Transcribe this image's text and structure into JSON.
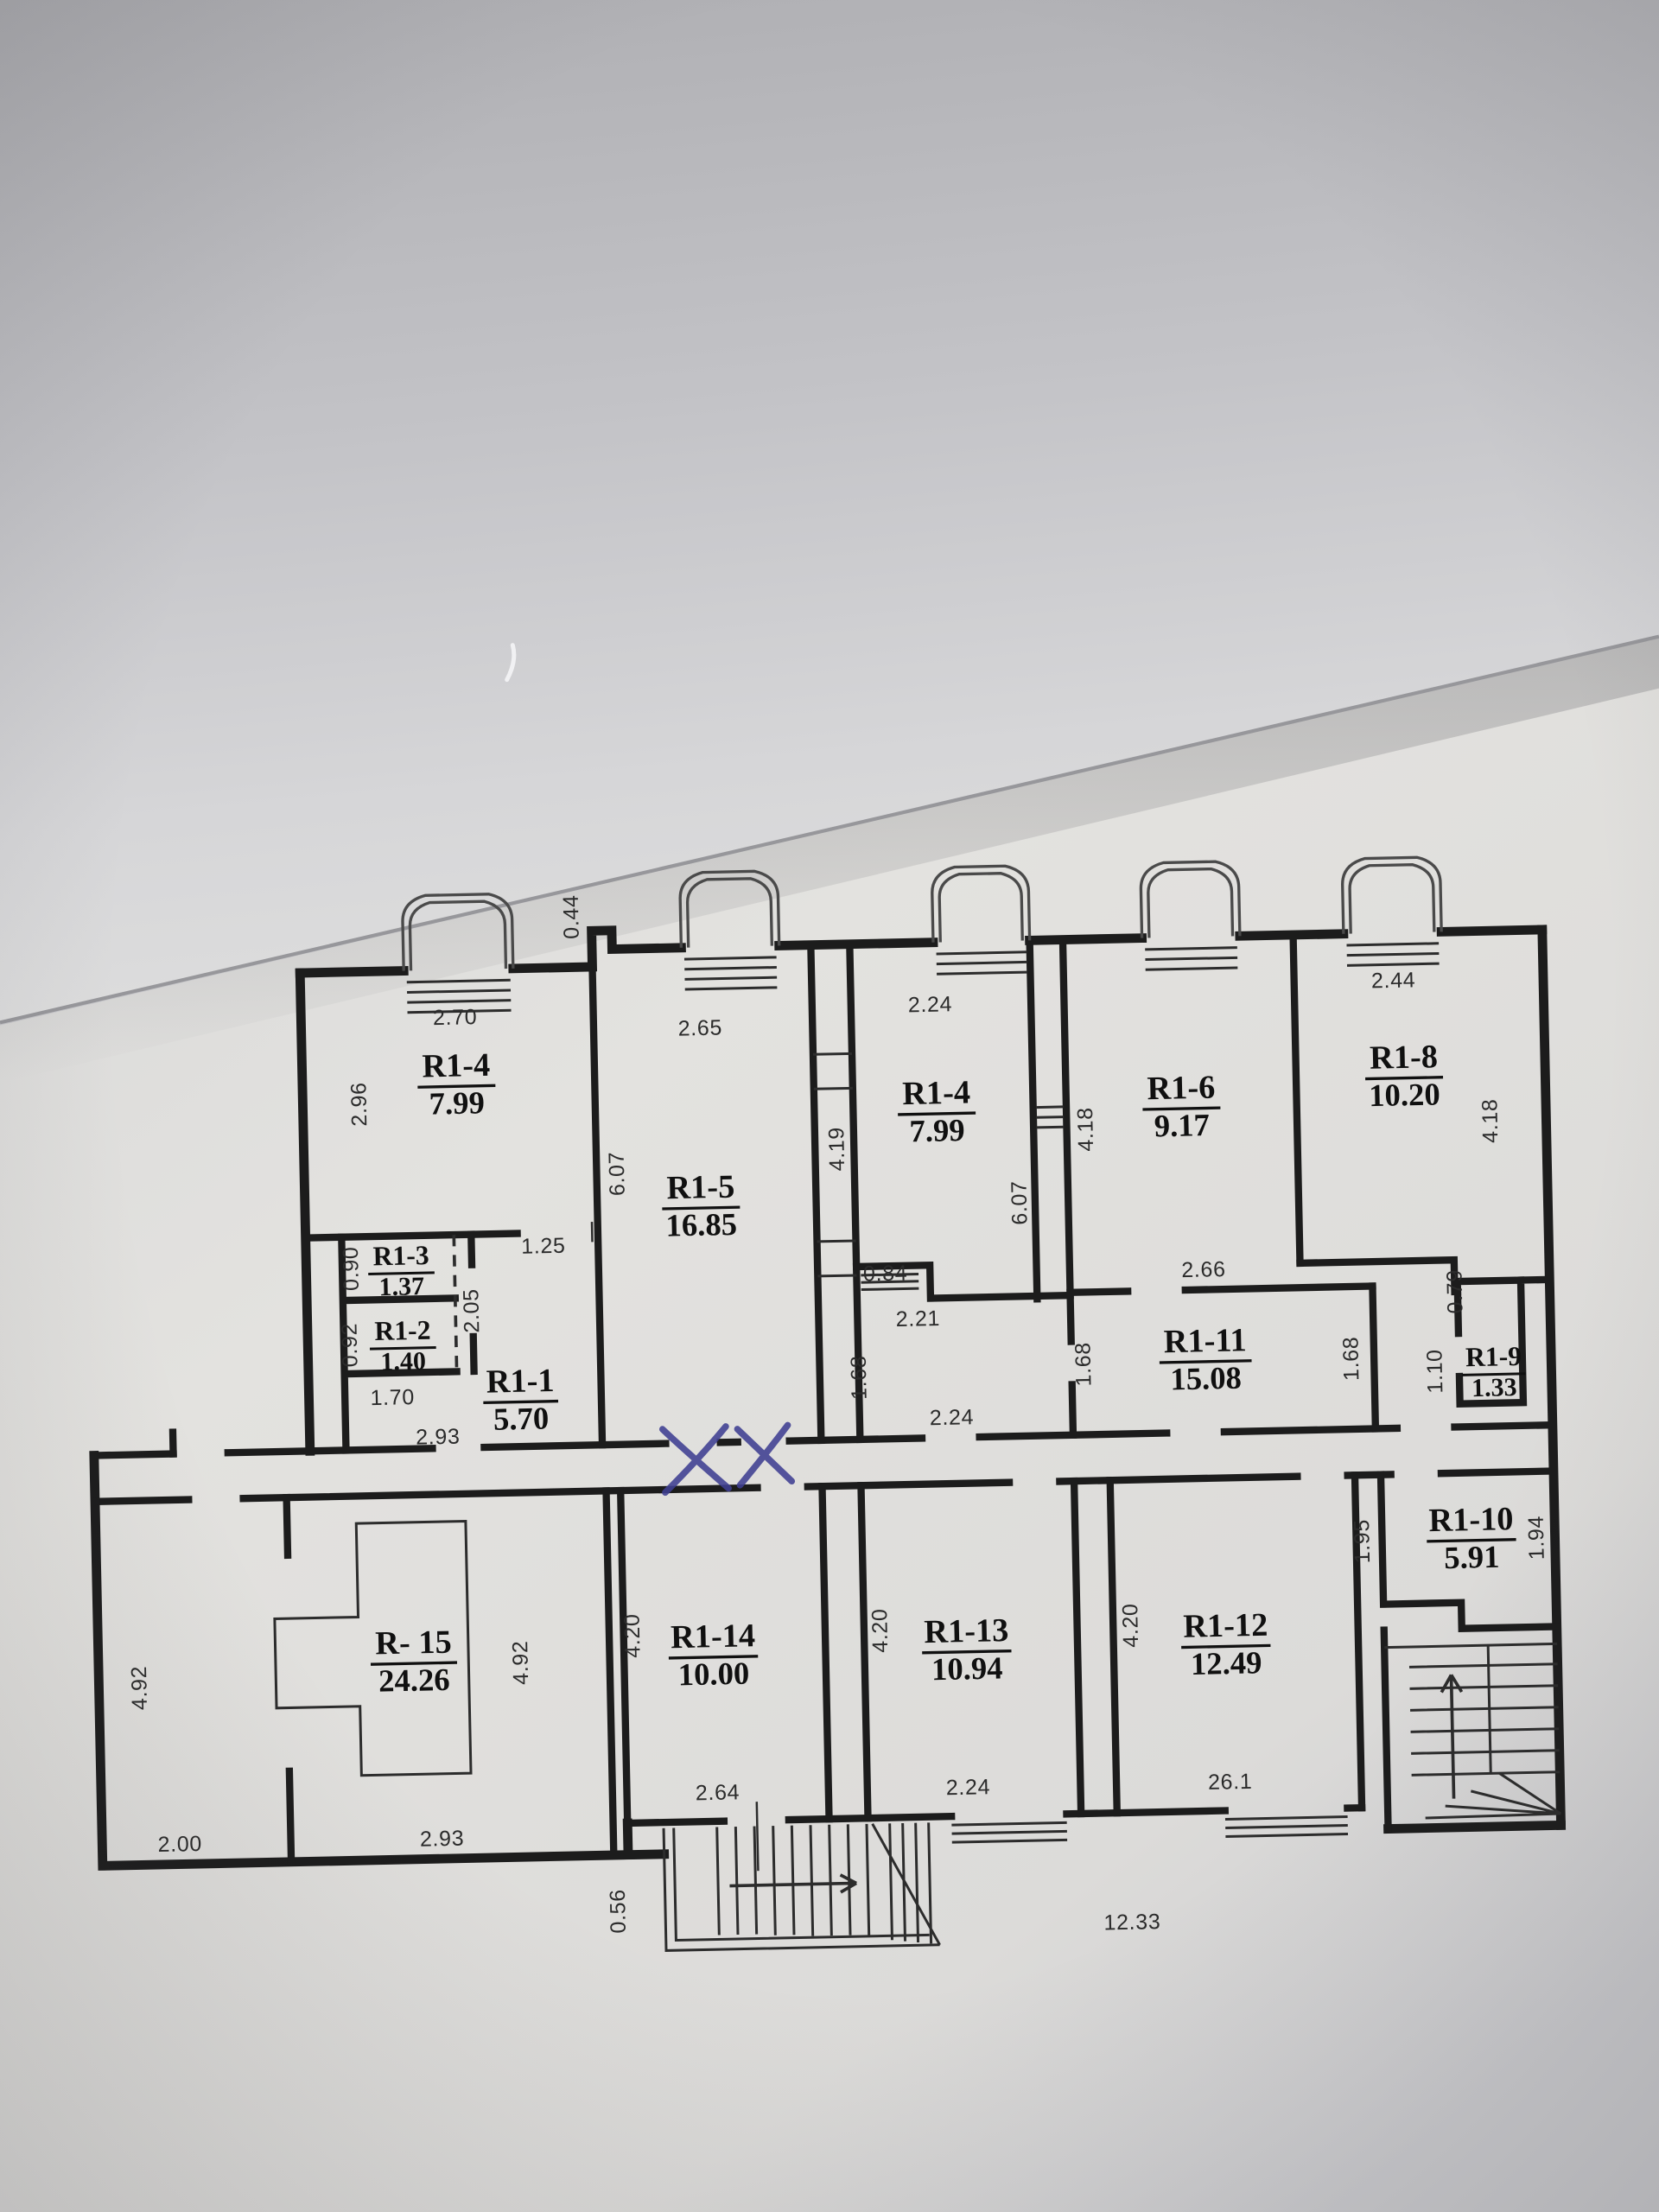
{
  "document_kind": "photographed floor plan sheet",
  "colors": {
    "ink": "#1c1c1c",
    "paper_light": "#e3e2df",
    "paper_shade": "#c6c6ca",
    "pen": "#3f3f92"
  },
  "rooms": [
    {
      "code": "R1-4",
      "area": "7.99"
    },
    {
      "code": "R1-5",
      "area": "16.85"
    },
    {
      "code": "R1-4",
      "area": "7.99"
    },
    {
      "code": "R1-6",
      "area": "9.17"
    },
    {
      "code": "R1-8",
      "area": "10.20"
    },
    {
      "code": "R1-3",
      "area": "1.37"
    },
    {
      "code": "R1-2",
      "area": "1.40"
    },
    {
      "code": "R1-1",
      "area": "5.70"
    },
    {
      "code": "R1-11",
      "area": "15.08"
    },
    {
      "code": "R1-9",
      "area": "1.33"
    },
    {
      "code": "R1-10",
      "area": "5.91"
    },
    {
      "code": "R- 15",
      "area": "24.26"
    },
    {
      "code": "R1-14",
      "area": "10.00"
    },
    {
      "code": "R1-13",
      "area": "10.94"
    },
    {
      "code": "R1-12",
      "area": "12.49"
    }
  ],
  "dims": [
    "2.70",
    "2.96",
    "0.44",
    "2.65",
    "6.07",
    "2.24",
    "4.19",
    "6.07",
    "4.18",
    "2.66",
    "2.44",
    "4.18",
    "1.25",
    "0.90",
    "2.05",
    "0.92",
    "1.70",
    "2.93",
    "0.84",
    "2.21",
    "1.68",
    "2.24",
    "1.68",
    "1.68",
    "0.79",
    "1.10",
    "1.95",
    "1.94",
    "4.92",
    "4.92",
    "2.00",
    "2.93",
    "4.20",
    "2.64",
    "4.20",
    "2.24",
    "4.20",
    "26.1",
    "12.33",
    "0.56"
  ],
  "annotations": {
    "pen_marks": [
      "X",
      "X"
    ],
    "pen_color": "#3f3f92"
  }
}
